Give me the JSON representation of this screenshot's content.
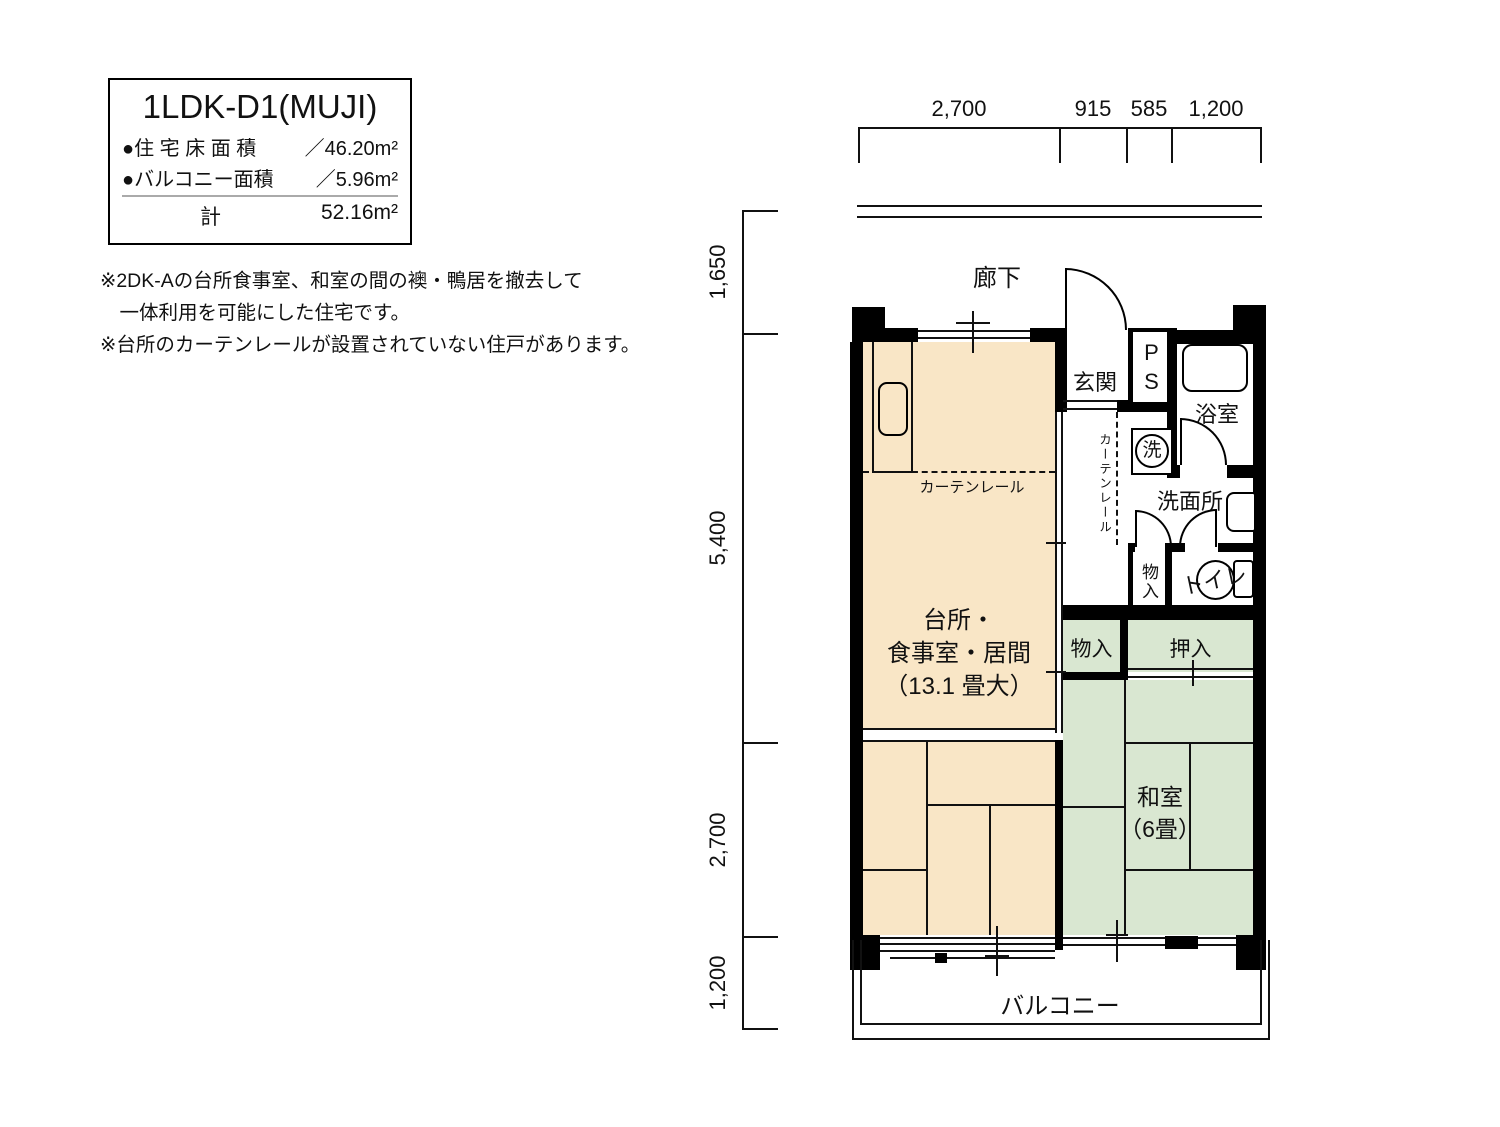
{
  "info_box": {
    "title": "1LDK-D1(MUJI)",
    "floor_area_label": "●住 宅 床 面 積",
    "floor_area_value": "／46.20m²",
    "balcony_area_label": "●バルコニー面積",
    "balcony_area_value": "／5.96m²",
    "total_label": "計",
    "total_value": "52.16m²"
  },
  "notes": {
    "line1": "※2DK-Aの台所食事室、和室の間の襖・鴨居を撤去して",
    "line2": "　一体利用を可能にした住宅です。",
    "line3": "※台所のカーテンレールが設置されていない住戸があります。"
  },
  "dimensions": {
    "top": {
      "d1": "2,700",
      "d2": "915",
      "d3": "585",
      "d4": "1,200"
    },
    "left": {
      "d1": "1,650",
      "d2": "5,400",
      "d3": "2,700",
      "d4": "1,200"
    }
  },
  "rooms": {
    "corridor": "廊下",
    "entrance": "玄関",
    "pipe_shaft": "PS",
    "bathroom": "浴室",
    "washing_machine": "洗",
    "curtain_rail_corridor": "カーテンレール",
    "washroom": "洗面所",
    "closet_hall": "物入",
    "toilet": "トイレ",
    "closet_small": "物入",
    "oshiire": "押入",
    "ldk_line1": "台所・",
    "ldk_line2": "食事室・居間",
    "ldk_line3": "（13.1 畳大）",
    "curtain_rail_kitchen": "カーテンレール",
    "washitsu_line1": "和室",
    "washitsu_line2": "（6畳）",
    "balcony": "バルコニー"
  },
  "colors": {
    "wall": "#000000",
    "ldk_floor": "#f9e6c6",
    "tatami_floor": "#d9e7d1",
    "line": "#111111"
  }
}
